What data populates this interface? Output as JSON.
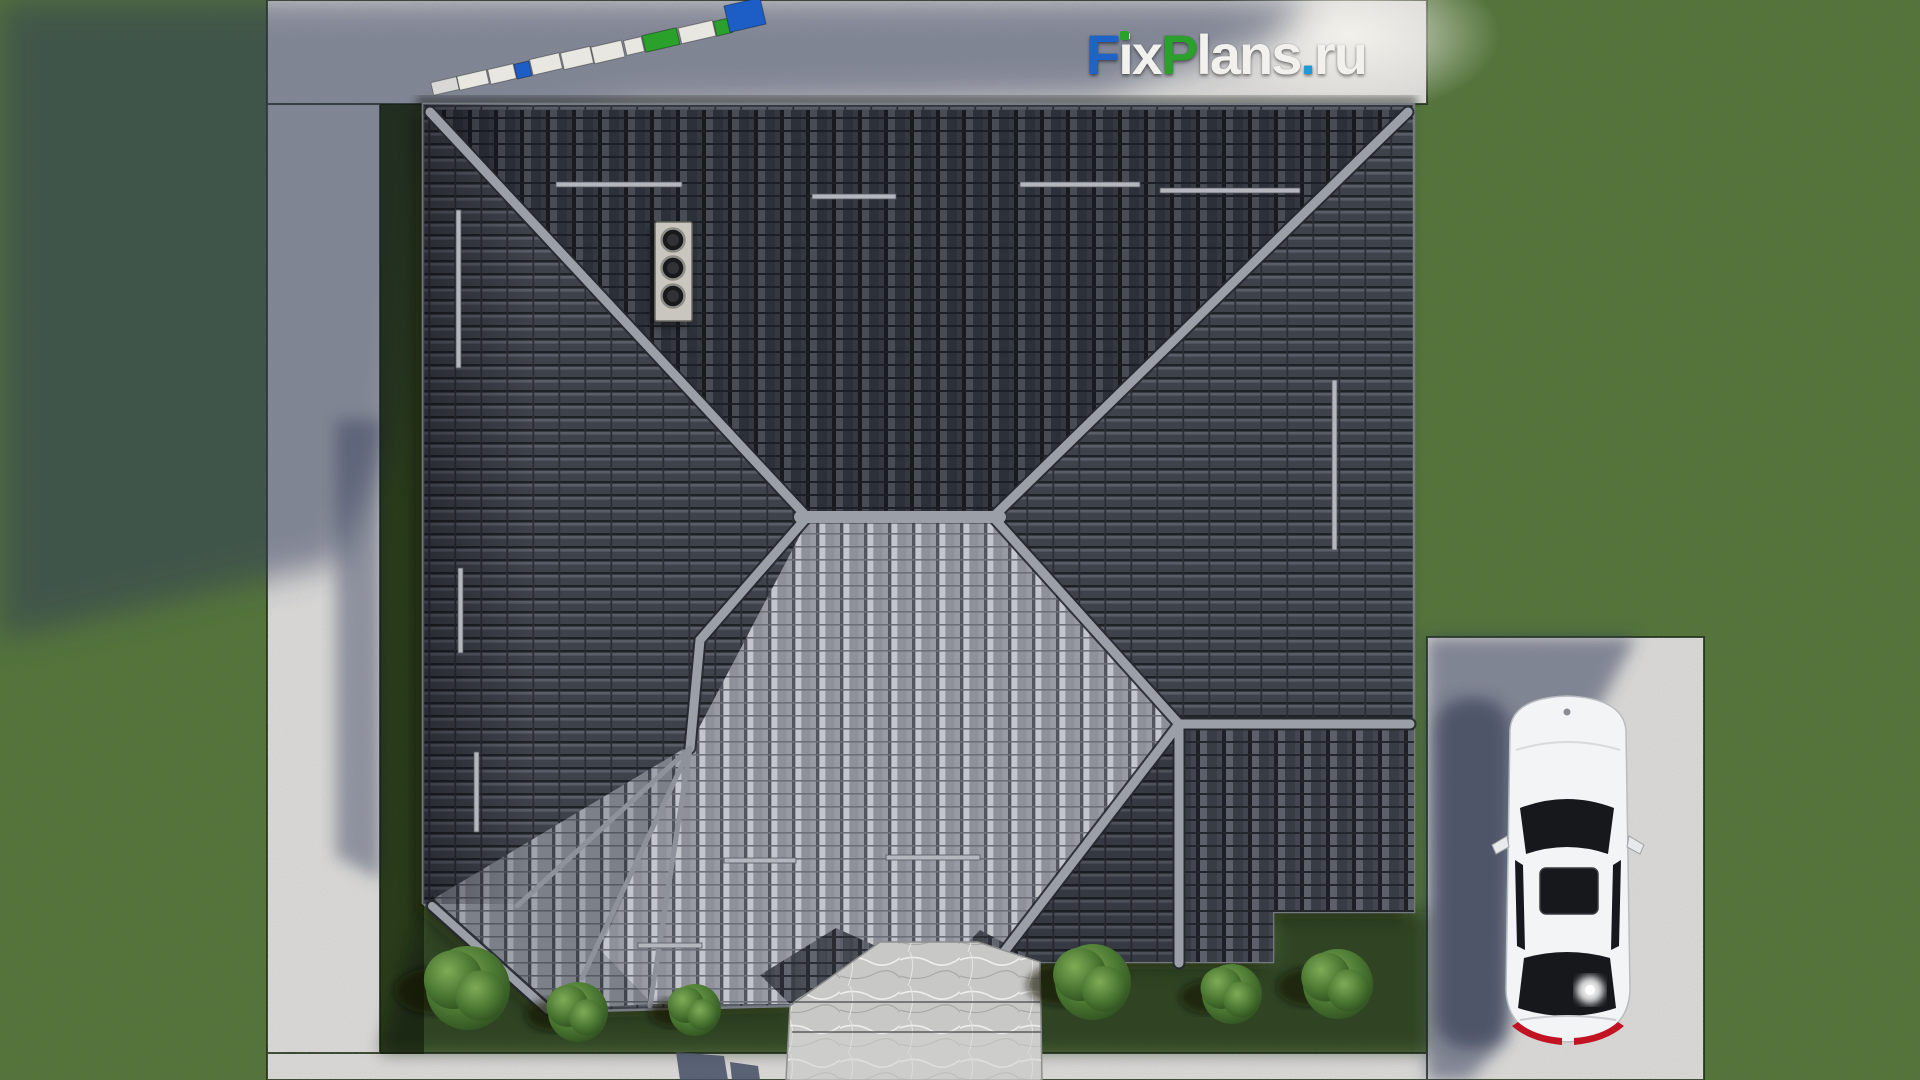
{
  "watermark": {
    "full": "FixPlans.ru",
    "f": "F",
    "i": "i",
    "x": "x",
    "p": "P",
    "lans": "lans",
    "dot": ".",
    "tld": "ru"
  },
  "palette": {
    "logo_blue": "#1e63c8",
    "logo_green": "#2ca02c",
    "logo_white": "#f2f1ee",
    "logo_dot_blue": "#1a9ad8",
    "grass": "#53753a",
    "concrete": "#dbdad8",
    "shadow_blue": "#2d3856",
    "roof_dark": "#3e424a",
    "roof_light": "#999ca4",
    "ridge": "#9ba0a8",
    "fascia": "#8d9199",
    "marble": "#cbcbc9",
    "car_body": "#f3f4f5",
    "car_glass": "#16181c",
    "taillight": "#c11322",
    "chimney_plate": "#c9c6bf",
    "ground_block_white": "#e9e7e2",
    "ground_block_blue": "#1d5ec6",
    "ground_block_green": "#2aa12a"
  },
  "ground_logo": {
    "blocks": [
      "white",
      "white",
      "white",
      "blue",
      "white",
      "white",
      "white",
      "white",
      "green",
      "white",
      "green",
      "blue"
    ]
  },
  "house": {
    "chimney_flues": 3
  },
  "landscape": {
    "bush_count": 6
  }
}
